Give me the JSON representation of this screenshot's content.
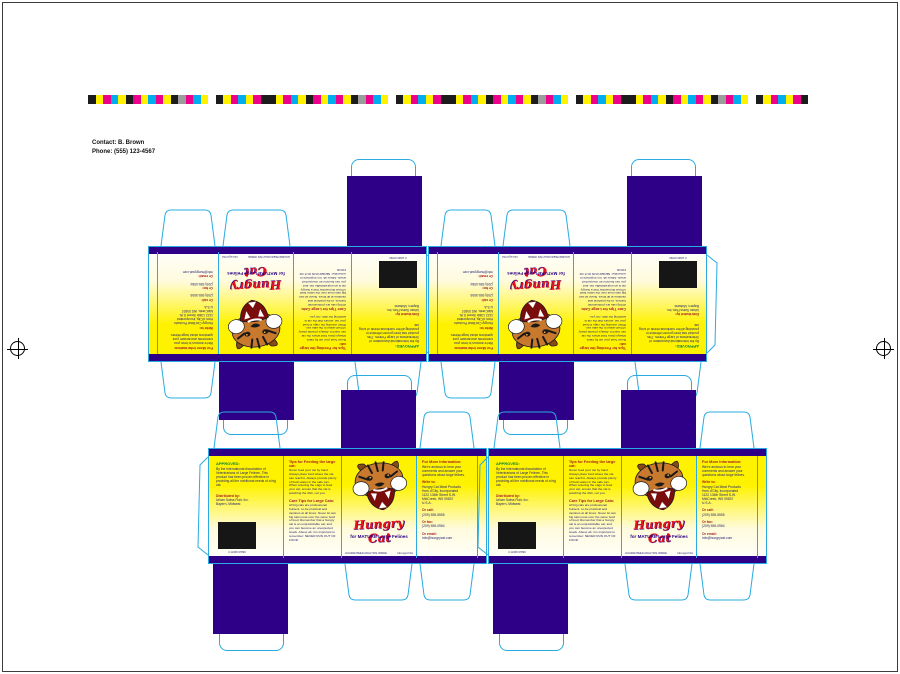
{
  "page": {
    "contact_line1": "Contact: B. Brown",
    "contact_line2": "Phone: (555) 123-4567"
  },
  "colors": {
    "navy": "#2D0087",
    "dieline_cyan": "#29ABE2",
    "panel_yellow": "#FFF200",
    "brand_red": "#E8131B",
    "approved_green": "#00833E",
    "heading_maroon": "#A81D22"
  },
  "colorbar": {
    "segments": [
      "#1c1c1c",
      "#fff100",
      "#ec008c",
      "#00aeef",
      "#fff100",
      "#1c1c1c",
      "#ec008c",
      "#fff100",
      "#00aeef",
      "#ec008c",
      "#fff100",
      "#1c1c1c",
      "#9c9c9c",
      "#ec008c",
      "#00aeef",
      "#fff100",
      "#ffffff",
      "#1c1c1c",
      "#fff100",
      "#ec008c",
      "#00aeef",
      "#fff100",
      "#ec008c",
      "#1c1c1c",
      "#1c1c1c",
      "#fff100",
      "#ec008c",
      "#00aeef",
      "#fff100",
      "#1c1c1c",
      "#ec008c",
      "#fff100",
      "#00aeef",
      "#ec008c",
      "#fff100",
      "#1c1c1c",
      "#9c9c9c",
      "#ec008c",
      "#00aeef",
      "#fff100",
      "#ffffff",
      "#1c1c1c",
      "#fff100",
      "#ec008c",
      "#00aeef",
      "#fff100",
      "#ec008c",
      "#1c1c1c",
      "#1c1c1c",
      "#fff100",
      "#ec008c",
      "#00aeef",
      "#fff100",
      "#1c1c1c",
      "#ec008c",
      "#fff100",
      "#00aeef",
      "#ec008c",
      "#fff100",
      "#1c1c1c",
      "#9c9c9c",
      "#ec008c",
      "#00aeef",
      "#fff100",
      "#ffffff",
      "#1c1c1c",
      "#fff100",
      "#ec008c",
      "#00aeef",
      "#fff100",
      "#ec008c",
      "#1c1c1c",
      "#1c1c1c",
      "#fff100",
      "#ec008c",
      "#00aeef",
      "#fff100",
      "#1c1c1c",
      "#ec008c",
      "#fff100",
      "#00aeef",
      "#ec008c",
      "#fff100",
      "#1c1c1c",
      "#9c9c9c",
      "#ec008c",
      "#00aeef",
      "#fff100",
      "#ffffff",
      "#1c1c1c",
      "#fff100",
      "#ec008c",
      "#00aeef",
      "#fff100",
      "#ec008c",
      "#1c1c1c"
    ]
  },
  "box": {
    "approved_panel": {
      "heading": "APPROVED:",
      "body": "By the International Association of Veterinarians of Large Felines. This product has been proven effective in providing all the nutritional needs of a big cat.",
      "distributed_heading": "Distributed by:",
      "distributed_line1": "Urban Swiss Flair, Inc.",
      "distributed_line2": "Bayern, Midwest",
      "barcode_caption": "0 12345 67890"
    },
    "tips_panel": {
      "heading1": "Tips for Feeding the large cat:",
      "body1": "Never feed your cat by hand. Always place food where the cat can reach it. Always provide plenty of fresh water in the safe can. When entering the cage to feed your cat, ensure that the cat is watching the dish, not you.",
      "heading2": "Care Tips for Large Cats:",
      "body2": "All big cats are professional hunters, so be practical and cautious at all times. Never let two big cats meet over the same bowl of food. Remember that a hungry cat is an unpredictable cat, and you can become an unexpected snack. Above all, it is important to remember: NEVER RUN OUT OF FOOD."
    },
    "logo_panel": {
      "brand": "Hungry Cat",
      "tagline": "for MATURE Large Felines",
      "footnote_left": "GUARANTEED ANALYSIS INSIDE",
      "footnote_right": "Net wgt 2 lbs"
    },
    "info_panel": {
      "heading": "For More Information:",
      "body": "We're anxious to hear your comments and answer your questions about large felines.",
      "write_heading": "Write to:",
      "address": [
        "Hungry Cat Meat Products",
        "Hors d'City, Incorporated",
        "1122 134th Street S.W.",
        "MidCreek, WS 09837",
        "U.S.A."
      ],
      "call_heading": "Or call:",
      "phone": "(209) 555-5555",
      "fax_heading": "Or fax:",
      "fax": "(209) 555-0984",
      "email_heading": "Or email:",
      "email": "info@hungrycat.com"
    }
  },
  "boxes": [
    {
      "x": 148,
      "y": 158,
      "rotated": true
    },
    {
      "x": 428,
      "y": 158,
      "rotated": true
    },
    {
      "x": 196,
      "y": 372,
      "rotated": false
    },
    {
      "x": 476,
      "y": 372,
      "rotated": false
    }
  ]
}
